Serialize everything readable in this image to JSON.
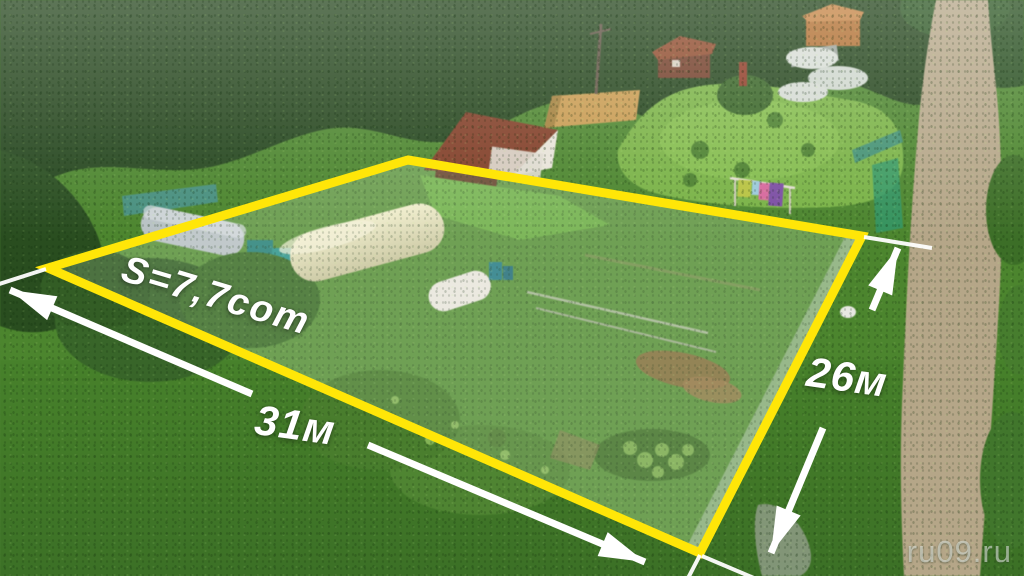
{
  "annotations": {
    "area_label": "S=7,7сот",
    "front_dimension_label": "31м",
    "side_dimension_label": "26м"
  },
  "watermark": {
    "text": "ru09.ru"
  },
  "colors": {
    "boundary": "#FFE608",
    "dimension_lines": "#FFFFFF",
    "overlay_fill": "rgba(255,255,255,0.13)"
  }
}
